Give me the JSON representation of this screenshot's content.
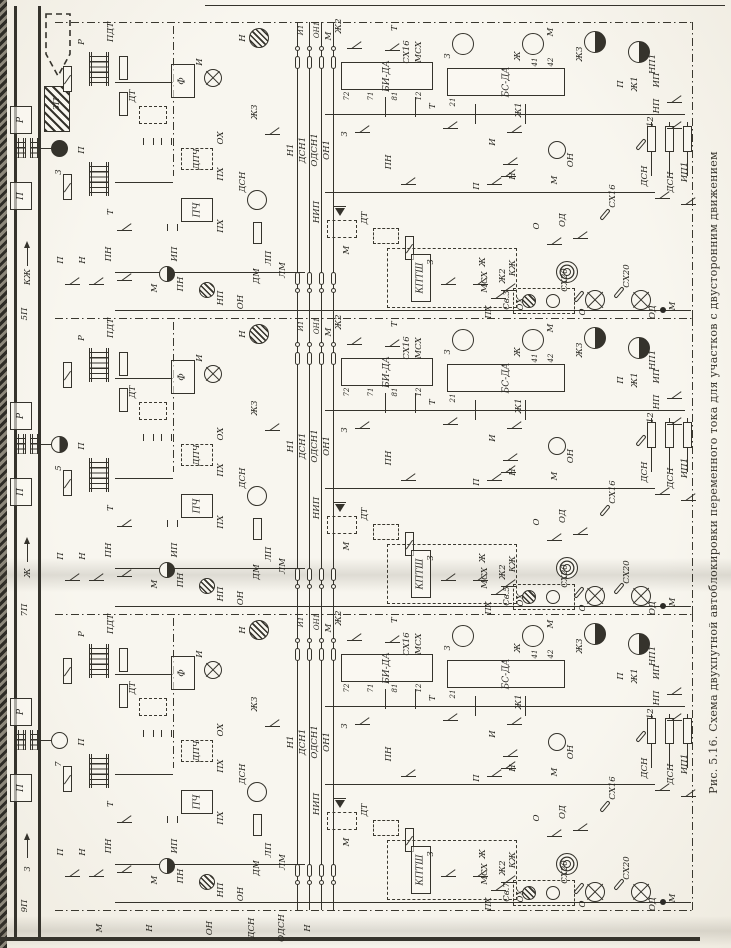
{
  "figure": {
    "caption": "Рис. 5.16. Схема двухпутной автоблокировки переменного тока для участков с двусторонним движением"
  },
  "track": {
    "sections": [
      "3П",
      "5П",
      "7П",
      "9П"
    ],
    "signals": [
      "3",
      "5",
      "7"
    ],
    "indications": [
      "КЖ",
      "Ж",
      "З"
    ]
  },
  "labels": {
    "r": "Р",
    "p": "П",
    "pdt": "ПДТ",
    "dt": "ДТ",
    "f": "Ф",
    "i": "И",
    "dpch": "ДПЧ",
    "pch": "ПЧ",
    "px": "ПХ",
    "ox": "ОХ",
    "t": "Т",
    "pn": "ПН",
    "on": "ОН",
    "n": "Н",
    "m": "М",
    "ip": "ИП",
    "nip": "НИП",
    "np": "НП",
    "np1": "НП1",
    "ip1": "ИП1",
    "kptsh": "КПТШ",
    "bi": "БИ-ДА",
    "bs": "БС-ДА",
    "z": "З",
    "zh": "Ж",
    "zh1": "Ж1",
    "zh2": "Ж2",
    "zh3": "Ж3",
    "kzh": "КЖ",
    "o": "О",
    "od": "ОД",
    "msx": "МСХ",
    "sx12": "СХ12",
    "sx16": "СХ16",
    "sx20": "СХ20",
    "dsn": "ДСН",
    "odsn": "ОДСН",
    "lp": "ЛП",
    "lm": "ЛМ",
    "dm": "ДМ",
    "n1": "Н1",
    "dsn1": "ДСН1",
    "odsn1": "ОДСН1",
    "on1": "ОН1",
    "i1": "И1",
    "t_bi": [
      "72",
      "71",
      "81",
      "12"
    ],
    "t_bs": [
      "21",
      "41",
      "42"
    ]
  },
  "bands": [
    {
      "sv": "Св.3"
    },
    {
      "sv": "Св.5"
    },
    {
      "sv": "Св.7"
    }
  ],
  "colors": {
    "ink": "#35332c",
    "paper": "#f8f6ef"
  }
}
